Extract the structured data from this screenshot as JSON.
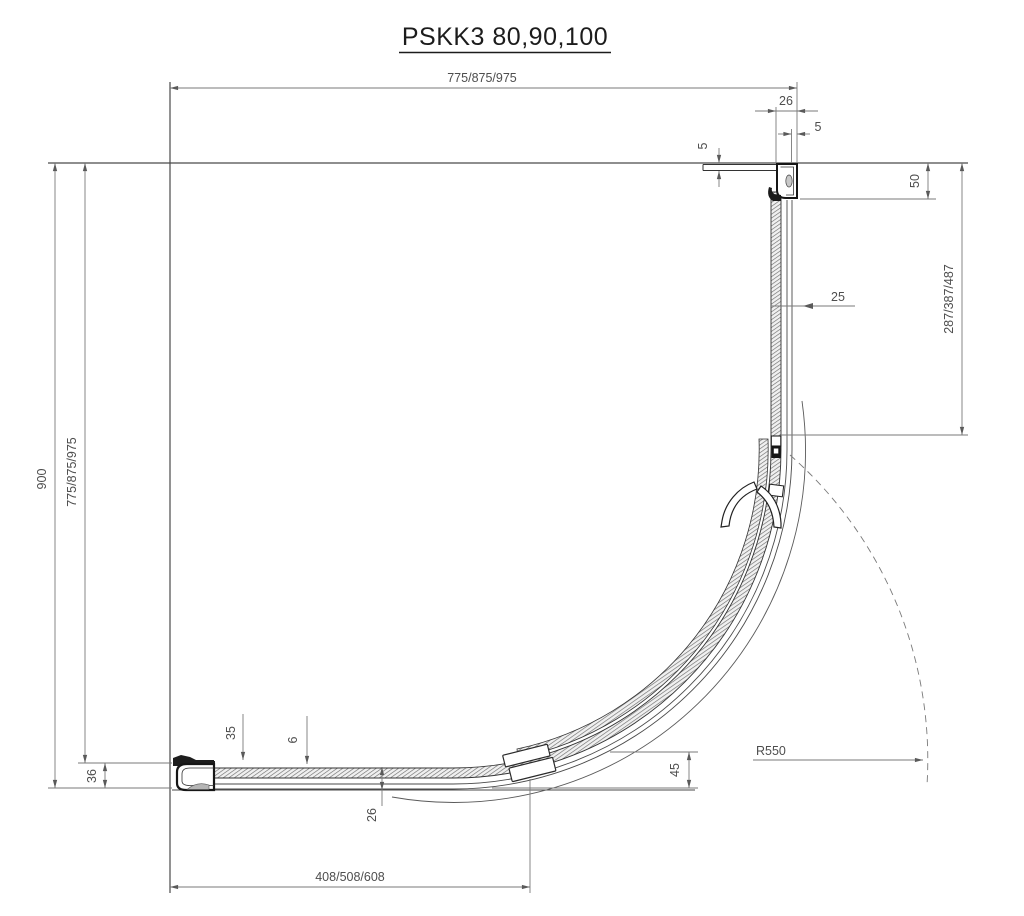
{
  "title": "PSKK3 80,90,100",
  "dims": {
    "top_width": "775/875/975",
    "top_profile_width": "26",
    "top_glass_offset": "5",
    "top_flange_thickness": "5",
    "right_profile_height": "50",
    "right_fixed_length": "287/387/487",
    "right_profile_depth": "25",
    "left_total_height": "900",
    "left_width": "775/875/975",
    "bottom_rail_height": "36",
    "bottom_profile_height": "35",
    "glass_thickness": "6",
    "bottom_rail_depth": "26",
    "door_opening_width": "408/508/608",
    "tray_offset": "45",
    "radius_label": "R550"
  },
  "colors": {
    "structure_line": "#4a4a4a",
    "profile_dark": "#161616",
    "dimension_line": "#7a7a7a",
    "dimension_text": "#4e4e4e",
    "glass_hatch": "#707070"
  }
}
